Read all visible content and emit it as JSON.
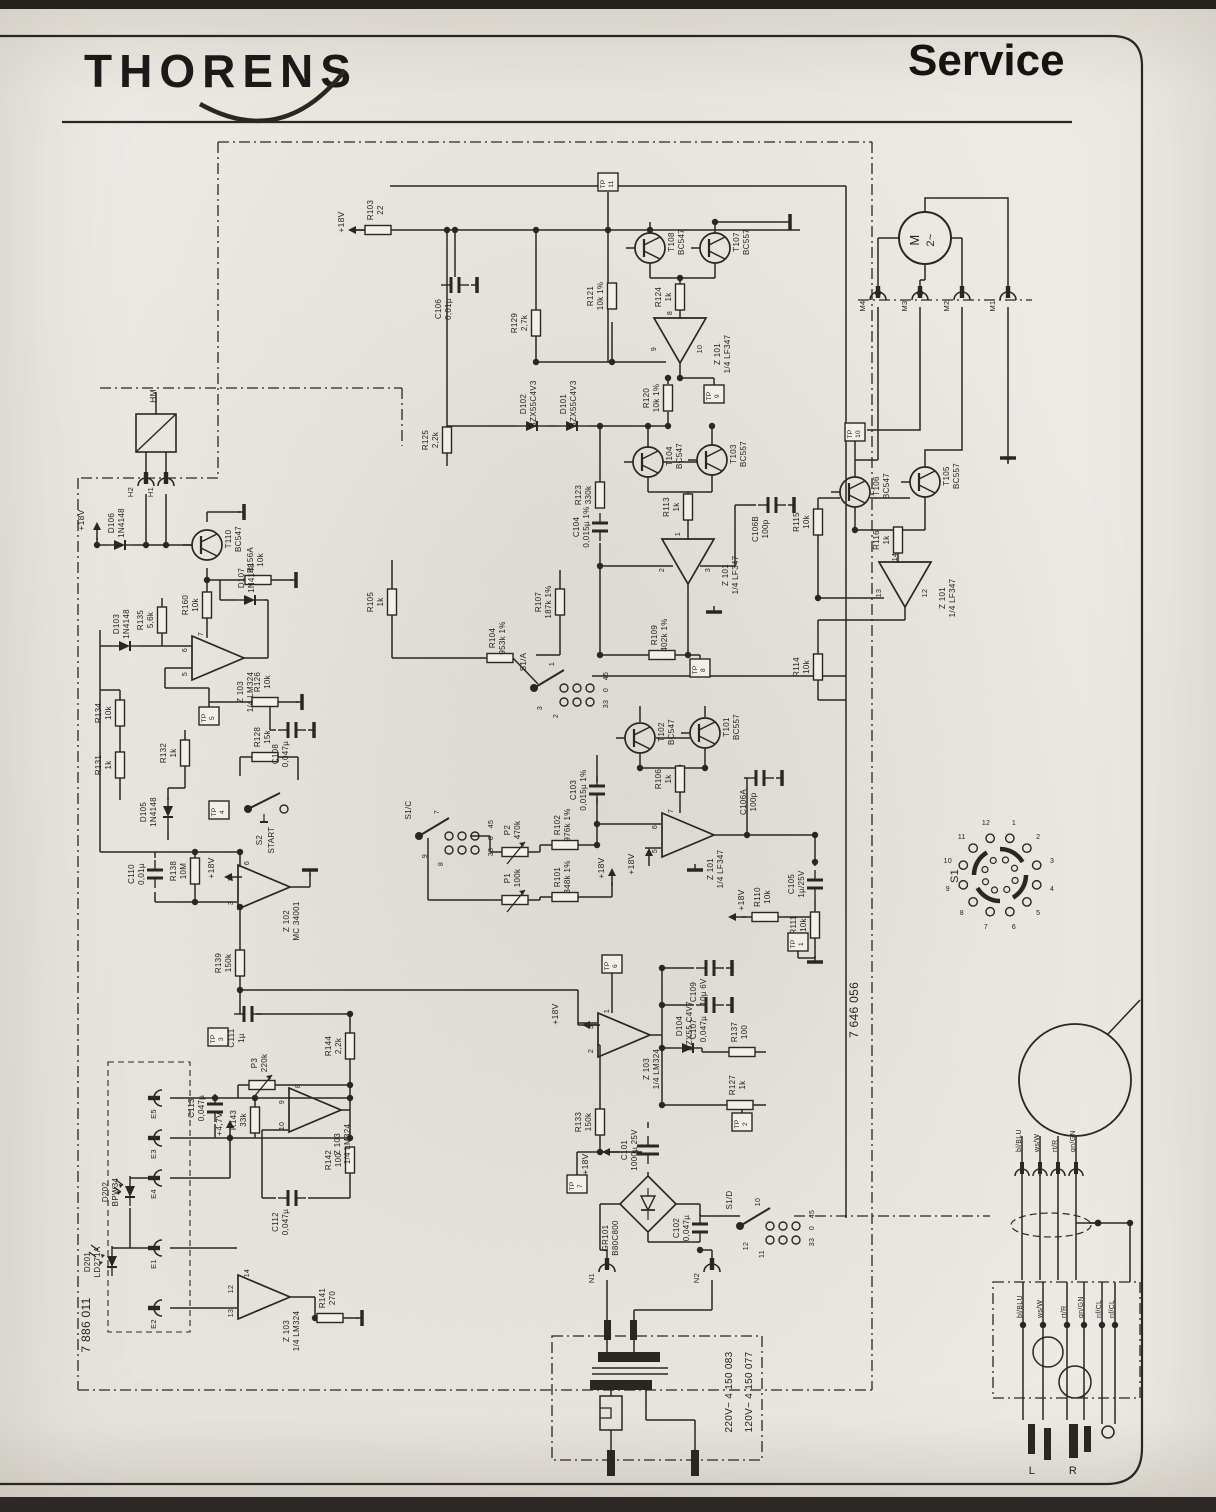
{
  "page": {
    "brand": "THORENS",
    "doc_type": "Service",
    "board_left": "7 886 011",
    "board_right": "7 646 056"
  },
  "schematic": {
    "resistors": [
      {
        "id": "R103",
        "v": "22",
        "x": 378,
        "y": 230,
        "o": "h"
      },
      {
        "id": "R121",
        "v": "10k 1%",
        "x": 612,
        "y": 296,
        "o": "v"
      },
      {
        "id": "R124",
        "v": "1k",
        "x": 680,
        "y": 297,
        "o": "v"
      },
      {
        "id": "R129",
        "v": "2,7k",
        "x": 536,
        "y": 323,
        "o": "v"
      },
      {
        "id": "R120",
        "v": "10k 1%",
        "x": 668,
        "y": 398,
        "o": "v"
      },
      {
        "id": "R125",
        "v": "2,2k",
        "x": 447,
        "y": 440,
        "o": "v"
      },
      {
        "id": "R123",
        "v": "330k",
        "x": 600,
        "y": 495,
        "o": "v"
      },
      {
        "id": "R113",
        "v": "1k",
        "x": 688,
        "y": 507,
        "o": "v"
      },
      {
        "id": "R115",
        "v": "10k",
        "x": 818,
        "y": 522,
        "o": "v"
      },
      {
        "id": "R116",
        "v": "1k",
        "x": 898,
        "y": 540,
        "o": "v"
      },
      {
        "id": "R114",
        "v": "10k",
        "x": 818,
        "y": 667,
        "o": "v"
      },
      {
        "id": "R156A",
        "v": "10k",
        "x": 258,
        "y": 580,
        "o": "h"
      },
      {
        "id": "R160",
        "v": "10k",
        "x": 207,
        "y": 605,
        "o": "v"
      },
      {
        "id": "R135",
        "v": "5,6k",
        "x": 162,
        "y": 620,
        "o": "v"
      },
      {
        "id": "R134",
        "v": "10k",
        "x": 120,
        "y": 713,
        "o": "v"
      },
      {
        "id": "R126",
        "v": "10k",
        "x": 265,
        "y": 702,
        "o": "h"
      },
      {
        "id": "R131",
        "v": "1k",
        "x": 120,
        "y": 765,
        "o": "v"
      },
      {
        "id": "R132",
        "v": "1k",
        "x": 185,
        "y": 753,
        "o": "v"
      },
      {
        "id": "R128",
        "v": "15k",
        "x": 265,
        "y": 757,
        "o": "h"
      },
      {
        "id": "R105",
        "v": "1k",
        "x": 392,
        "y": 602,
        "o": "v"
      },
      {
        "id": "R107",
        "v": "187k 1%",
        "x": 560,
        "y": 602,
        "o": "v"
      },
      {
        "id": "R104",
        "v": "953k 1%",
        "x": 500,
        "y": 658,
        "o": "h"
      },
      {
        "id": "R109",
        "v": "402k 1%",
        "x": 662,
        "y": 655,
        "o": "h"
      },
      {
        "id": "R138",
        "v": "10M",
        "x": 195,
        "y": 871,
        "o": "v"
      },
      {
        "id": "R139",
        "v": "150k",
        "x": 240,
        "y": 963,
        "o": "v"
      },
      {
        "id": "R102",
        "v": "976k 1%",
        "x": 565,
        "y": 845,
        "o": "h"
      },
      {
        "id": "R101",
        "v": "348k 1%",
        "x": 565,
        "y": 897,
        "o": "h"
      },
      {
        "id": "R106",
        "v": "1k",
        "x": 680,
        "y": 779,
        "o": "v"
      },
      {
        "id": "R110",
        "v": "10k",
        "x": 765,
        "y": 917,
        "o": "h"
      },
      {
        "id": "R111",
        "v": "10k",
        "x": 815,
        "y": 925,
        "o": "v"
      },
      {
        "id": "R137",
        "v": "100",
        "x": 742,
        "y": 1052,
        "o": "h"
      },
      {
        "id": "R127",
        "v": "1k",
        "x": 740,
        "y": 1105,
        "o": "h"
      },
      {
        "id": "R133",
        "v": "150k",
        "x": 600,
        "y": 1122,
        "o": "v"
      },
      {
        "id": "R144",
        "v": "2,2k",
        "x": 350,
        "y": 1046,
        "o": "v"
      },
      {
        "id": "R143",
        "v": "33k",
        "x": 255,
        "y": 1120,
        "o": "v"
      },
      {
        "id": "R142",
        "v": "100",
        "x": 350,
        "y": 1160,
        "o": "v"
      },
      {
        "id": "R141",
        "v": "270",
        "x": 330,
        "y": 1318,
        "o": "h"
      }
    ],
    "capacitors": [
      {
        "id": "C106",
        "v": "0,01µ",
        "x": 455,
        "y": 285,
        "o": "h",
        "g": 1
      },
      {
        "id": "C110",
        "v": "0,01µ",
        "x": 155,
        "y": 874,
        "o": "v"
      },
      {
        "id": "C104",
        "v": "0,015µ 1%",
        "x": 600,
        "y": 527,
        "o": "v"
      },
      {
        "id": "C103",
        "v": "0,015µ 1%",
        "x": 597,
        "y": 790,
        "o": "v"
      },
      {
        "id": "C106B",
        "v": "100p",
        "x": 772,
        "y": 505,
        "o": "h",
        "g": 1
      },
      {
        "id": "C106A",
        "v": "100p",
        "x": 760,
        "y": 778,
        "o": "h",
        "g": 1
      },
      {
        "id": "C105",
        "v": "1µ/25V",
        "x": 815,
        "y": 884,
        "o": "v"
      },
      {
        "id": "C108",
        "v": "0,047µ",
        "x": 292,
        "y": 730,
        "o": "h",
        "g": 1
      },
      {
        "id": "C109",
        "v": "10µ 6V",
        "x": 710,
        "y": 968,
        "o": "h",
        "g": 1
      },
      {
        "id": "C107",
        "v": "0,047µ",
        "x": 710,
        "y": 1005,
        "o": "h",
        "g": 1
      },
      {
        "id": "C111",
        "v": "1µ",
        "x": 248,
        "y": 1014,
        "o": "h"
      },
      {
        "id": "C113",
        "v": "0,047µ",
        "x": 215,
        "y": 1108,
        "o": "v"
      },
      {
        "id": "C112",
        "v": "0,047µ",
        "x": 292,
        "y": 1198,
        "o": "h"
      },
      {
        "id": "C101",
        "v": "1000µ 25V",
        "x": 648,
        "y": 1150,
        "o": "v",
        "big": 1
      },
      {
        "id": "C102",
        "v": "0,047µ",
        "x": 700,
        "y": 1228,
        "o": "v"
      }
    ],
    "transistors": [
      {
        "id": "T108",
        "part": "BC547",
        "x": 650,
        "y": 248
      },
      {
        "id": "T107",
        "part": "BC557",
        "x": 715,
        "y": 248
      },
      {
        "id": "T110",
        "part": "BC547",
        "x": 207,
        "y": 545
      },
      {
        "id": "T104",
        "part": "BC547",
        "x": 648,
        "y": 462
      },
      {
        "id": "T103",
        "part": "BC557",
        "x": 712,
        "y": 460
      },
      {
        "id": "T106",
        "part": "BC547",
        "x": 855,
        "y": 492
      },
      {
        "id": "T105",
        "part": "BC557",
        "x": 925,
        "y": 482
      },
      {
        "id": "T102",
        "part": "BC547",
        "x": 640,
        "y": 738
      },
      {
        "id": "T101",
        "part": "BC557",
        "x": 705,
        "y": 733
      }
    ],
    "opamps": [
      {
        "id": "Z 101",
        "part": "1/4 LF347",
        "x": 680,
        "y": 340,
        "dir": "d",
        "pins": [
          "8",
          "9",
          "10"
        ]
      },
      {
        "id": "Z 101",
        "part": "1/4 LF347",
        "x": 688,
        "y": 561,
        "dir": "d",
        "pins": [
          "1",
          "2",
          "3"
        ]
      },
      {
        "id": "Z 101",
        "part": "1/4 LF347",
        "x": 905,
        "y": 584,
        "dir": "d",
        "pins": [
          "14",
          "13",
          "12"
        ]
      },
      {
        "id": "Z 101",
        "part": "1/4 LF347",
        "x": 687,
        "y": 835,
        "dir": "r",
        "pins": [
          "7",
          "6",
          "5"
        ]
      },
      {
        "id": "Z 103",
        "part": "1/4 LM324",
        "x": 217,
        "y": 658,
        "dir": "r",
        "pins": [
          "7",
          "6",
          "5"
        ]
      },
      {
        "id": "Z 102",
        "part": "MC 34001",
        "x": 263,
        "y": 887,
        "dir": "r",
        "pins": [
          "6",
          "2",
          "3"
        ]
      },
      {
        "id": "Z 103",
        "part": "1/4 LM324",
        "x": 623,
        "y": 1035,
        "dir": "r",
        "pins": [
          "1",
          "3",
          "2"
        ]
      },
      {
        "id": "Z 103",
        "part": "1/4 LM324",
        "x": 314,
        "y": 1110,
        "dir": "r",
        "pins": [
          "8",
          "9",
          "10"
        ]
      },
      {
        "id": "Z 103",
        "part": "1/4 LM324",
        "x": 263,
        "y": 1297,
        "dir": "r",
        "pins": [
          "14",
          "12",
          "13"
        ]
      }
    ],
    "diodes": [
      {
        "id": "D106",
        "part": "1N4148",
        "x": 120,
        "y": 545,
        "o": "h"
      },
      {
        "id": "D103",
        "part": "1N4148",
        "x": 125,
        "y": 646,
        "o": "h"
      },
      {
        "id": "D107",
        "part": "1N4148",
        "x": 250,
        "y": 600,
        "o": "h"
      },
      {
        "id": "D105",
        "part": "1N4148",
        "x": 168,
        "y": 812,
        "o": "v"
      },
      {
        "id": "D102",
        "part": "BZX55C4V3",
        "x": 532,
        "y": 426,
        "o": "h"
      },
      {
        "id": "D101",
        "part": "BZX55C4V3",
        "x": 572,
        "y": 426,
        "o": "h"
      },
      {
        "id": "D104",
        "part": "BZX55 C4V7",
        "x": 688,
        "y": 1048,
        "o": "h"
      },
      {
        "id": "D202",
        "part": "BPW34",
        "x": 130,
        "y": 1192,
        "o": "v",
        "k": "photo"
      },
      {
        "id": "D201",
        "part": "LD271A",
        "x": 112,
        "y": 1262,
        "o": "v",
        "k": "led"
      }
    ],
    "testpoints": [
      {
        "n": "11",
        "x": 608,
        "y": 182
      },
      {
        "n": "9",
        "x": 714,
        "y": 394
      },
      {
        "n": "10",
        "x": 855,
        "y": 432
      },
      {
        "n": "5",
        "x": 209,
        "y": 716
      },
      {
        "n": "4",
        "x": 219,
        "y": 810
      },
      {
        "n": "8",
        "x": 700,
        "y": 668
      },
      {
        "n": "6",
        "x": 612,
        "y": 964
      },
      {
        "n": "1",
        "x": 798,
        "y": 942
      },
      {
        "n": "2",
        "x": 742,
        "y": 1122
      },
      {
        "n": "7",
        "x": 577,
        "y": 1184
      },
      {
        "n": "3",
        "x": 218,
        "y": 1037
      }
    ],
    "connectors": [
      {
        "id": "H2",
        "x": 146,
        "y": 486,
        "r": 0
      },
      {
        "id": "H1",
        "x": 166,
        "y": 486,
        "r": 0
      },
      {
        "id": "M4",
        "x": 878,
        "y": 300,
        "r": 0
      },
      {
        "id": "M3",
        "x": 920,
        "y": 300,
        "r": 0
      },
      {
        "id": "M2",
        "x": 962,
        "y": 300,
        "r": 0
      },
      {
        "id": "M1",
        "x": 1008,
        "y": 300,
        "r": 0
      },
      {
        "id": "E5",
        "x": 162,
        "y": 1098,
        "r": -90
      },
      {
        "id": "E3",
        "x": 162,
        "y": 1138,
        "r": -90
      },
      {
        "id": "E4",
        "x": 162,
        "y": 1178,
        "r": -90
      },
      {
        "id": "E1",
        "x": 162,
        "y": 1248,
        "r": -90
      },
      {
        "id": "E2",
        "x": 162,
        "y": 1308,
        "r": -90
      },
      {
        "id": "N1",
        "x": 607,
        "y": 1272,
        "r": 0
      },
      {
        "id": "N2",
        "x": 712,
        "y": 1272,
        "r": 0
      }
    ],
    "switches": [
      {
        "id": "S1/A",
        "x": 556,
        "y": 678,
        "rows": [
          "1",
          "2",
          "3"
        ],
        "cols": [
          "45",
          "0",
          "33"
        ]
      },
      {
        "id": "S1/C",
        "x": 441,
        "y": 826,
        "rows": [
          "7",
          "8",
          "9"
        ],
        "cols": [
          "45",
          "0",
          "33"
        ]
      },
      {
        "id": "S1/D",
        "x": 762,
        "y": 1216,
        "rows": [
          "10",
          "11",
          "12"
        ],
        "cols": [
          "45",
          "0",
          "33"
        ]
      }
    ],
    "start_switch": {
      "id": "S2",
      "label": "START",
      "x": 266,
      "y": 800
    },
    "pots": [
      {
        "id": "P2",
        "v": "470k",
        "x": 515,
        "y": 852
      },
      {
        "id": "P1",
        "v": "100k",
        "x": 515,
        "y": 900
      },
      {
        "id": "P3",
        "v": "220k",
        "x": 262,
        "y": 1085
      }
    ],
    "motor": {
      "id": "M",
      "t": "2~",
      "x": 925,
      "y": 238
    },
    "relay": {
      "id": "HM",
      "x": 136,
      "y": 414
    },
    "bridge": {
      "id": "GR101",
      "part": "B80C800",
      "x": 648,
      "y": 1204
    },
    "rotary": {
      "id": "S1",
      "x": 1000,
      "y": 875,
      "positions": [
        "1",
        "2",
        "3",
        "4",
        "5",
        "6",
        "7",
        "8",
        "9",
        "10",
        "11",
        "12"
      ]
    },
    "transformer": {
      "variants": [
        "220V~ 4 150 083",
        "120V~ 4 150 077"
      ]
    },
    "wiring": {
      "cart_wires": [
        "bl/BLU",
        "ws/W",
        "rt/R",
        "gn/GN"
      ],
      "box_wires": [
        "bl/BLU",
        "ws/W",
        "rt/R",
        "gn/GN",
        "nf/CL",
        "nf/CL"
      ],
      "outputs": [
        "L",
        "R"
      ]
    },
    "labels": [
      {
        "t": "+18V",
        "x": 344,
        "y": 222
      },
      {
        "t": "+18V",
        "x": 84,
        "y": 520
      },
      {
        "t": "+18V",
        "x": 214,
        "y": 868
      },
      {
        "t": "+18V",
        "x": 634,
        "y": 864
      },
      {
        "t": "+18V",
        "x": 744,
        "y": 900
      },
      {
        "t": "+18V",
        "x": 604,
        "y": 868
      },
      {
        "t": "+18V",
        "x": 558,
        "y": 1014
      },
      {
        "t": "+18V",
        "x": 588,
        "y": 1164
      },
      {
        "t": "+4,7V",
        "x": 222,
        "y": 1124
      },
      {
        "t": "HM",
        "x": 156,
        "y": 396
      },
      {
        "t": "S1",
        "x": 958,
        "y": 876,
        "s": 11
      }
    ]
  }
}
